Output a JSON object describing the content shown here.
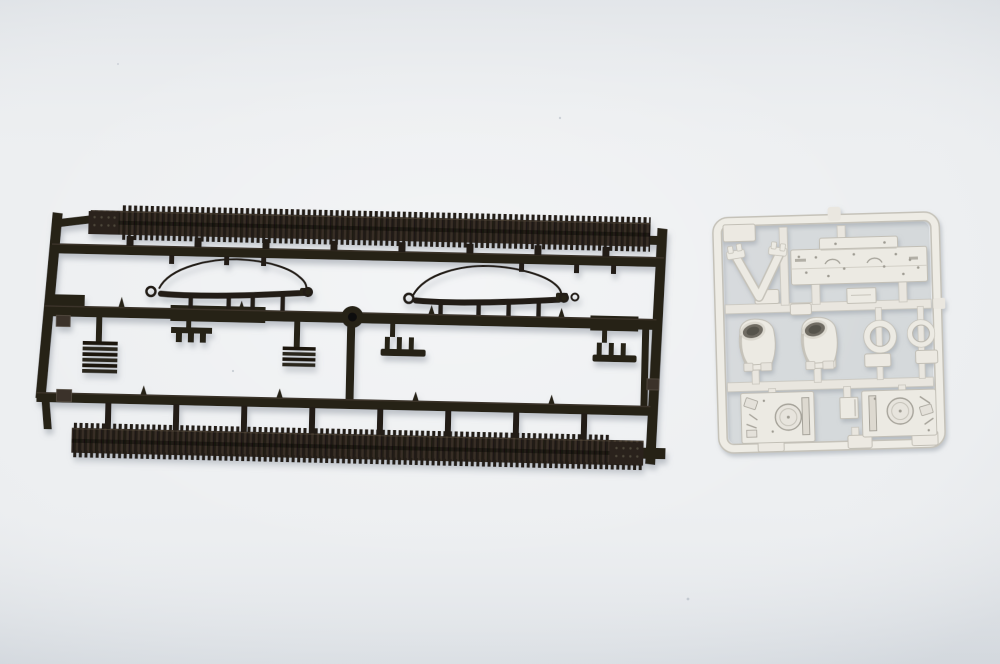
{
  "meta": {
    "content_type": "photograph",
    "description": "Top-down photograph of two injection-moulded model-kit sprues lying on a pale blue-grey surface: a large dark-brown runner carrying two long ribbed tank-track strips, two moulded tow cables, slatted grilles and small brackets; and a smaller cream runner carrying hull, turret and hatch detail parts."
  },
  "colors": {
    "background": "#edeff1",
    "background_edge": "#e2e6ea",
    "dark_sprue": "#262019",
    "dark_sprue_highlight": "#4b4237",
    "track_rib_light": "#382f25",
    "track_rib_dark": "#191410",
    "light_sprue": "#eceae3",
    "light_sprue_shade": "#c2bfb6",
    "light_sprue_detail": "#a5a299",
    "opening_dark": "#6f6c64",
    "shadow": "#98a0a9"
  },
  "dark_sprue": {
    "label": "dark styrene runner with tank tracks",
    "parts": [
      {
        "id": "upper-track-strip",
        "label": "upper ribbed tank-track length with perforated end plate"
      },
      {
        "id": "lower-track-strip",
        "label": "lower ribbed tank-track length with perforated end plate"
      },
      {
        "id": "tow-cable-left",
        "label": "moulded tow cable with looped wire and eyelets"
      },
      {
        "id": "tow-cable-right",
        "label": "moulded tow cable with looped wire and eyelets"
      },
      {
        "id": "grille-left",
        "label": "slatted grille block"
      },
      {
        "id": "grille-right",
        "label": "slatted grille block"
      },
      {
        "id": "comb-bracket-1",
        "label": "small pronged bracket"
      },
      {
        "id": "comb-bracket-2",
        "label": "small pronged bracket"
      },
      {
        "id": "comb-bracket-3",
        "label": "small pronged bracket"
      },
      {
        "id": "hub-boss",
        "label": "round runner junction boss"
      }
    ]
  },
  "light_sprue": {
    "label": "cream styrene runner with detail parts",
    "parts": [
      {
        "id": "v-mount",
        "label": "V-shaped mount with flanged tips"
      },
      {
        "id": "deck-plate",
        "label": "flat engine-deck plate with arcs and rivet holes"
      },
      {
        "id": "housing-left",
        "label": "open-topped round housing"
      },
      {
        "id": "housing-right",
        "label": "open-topped round housing"
      },
      {
        "id": "ring-large",
        "label": "large hatch ring"
      },
      {
        "id": "ring-small",
        "label": "small hatch ring"
      },
      {
        "id": "roof-panel-left",
        "label": "roof panel with circular hatch and slot"
      },
      {
        "id": "roof-panel-right",
        "label": "roof panel with circular hatch and slot"
      },
      {
        "id": "small-block",
        "label": "small rectangular block"
      }
    ]
  }
}
